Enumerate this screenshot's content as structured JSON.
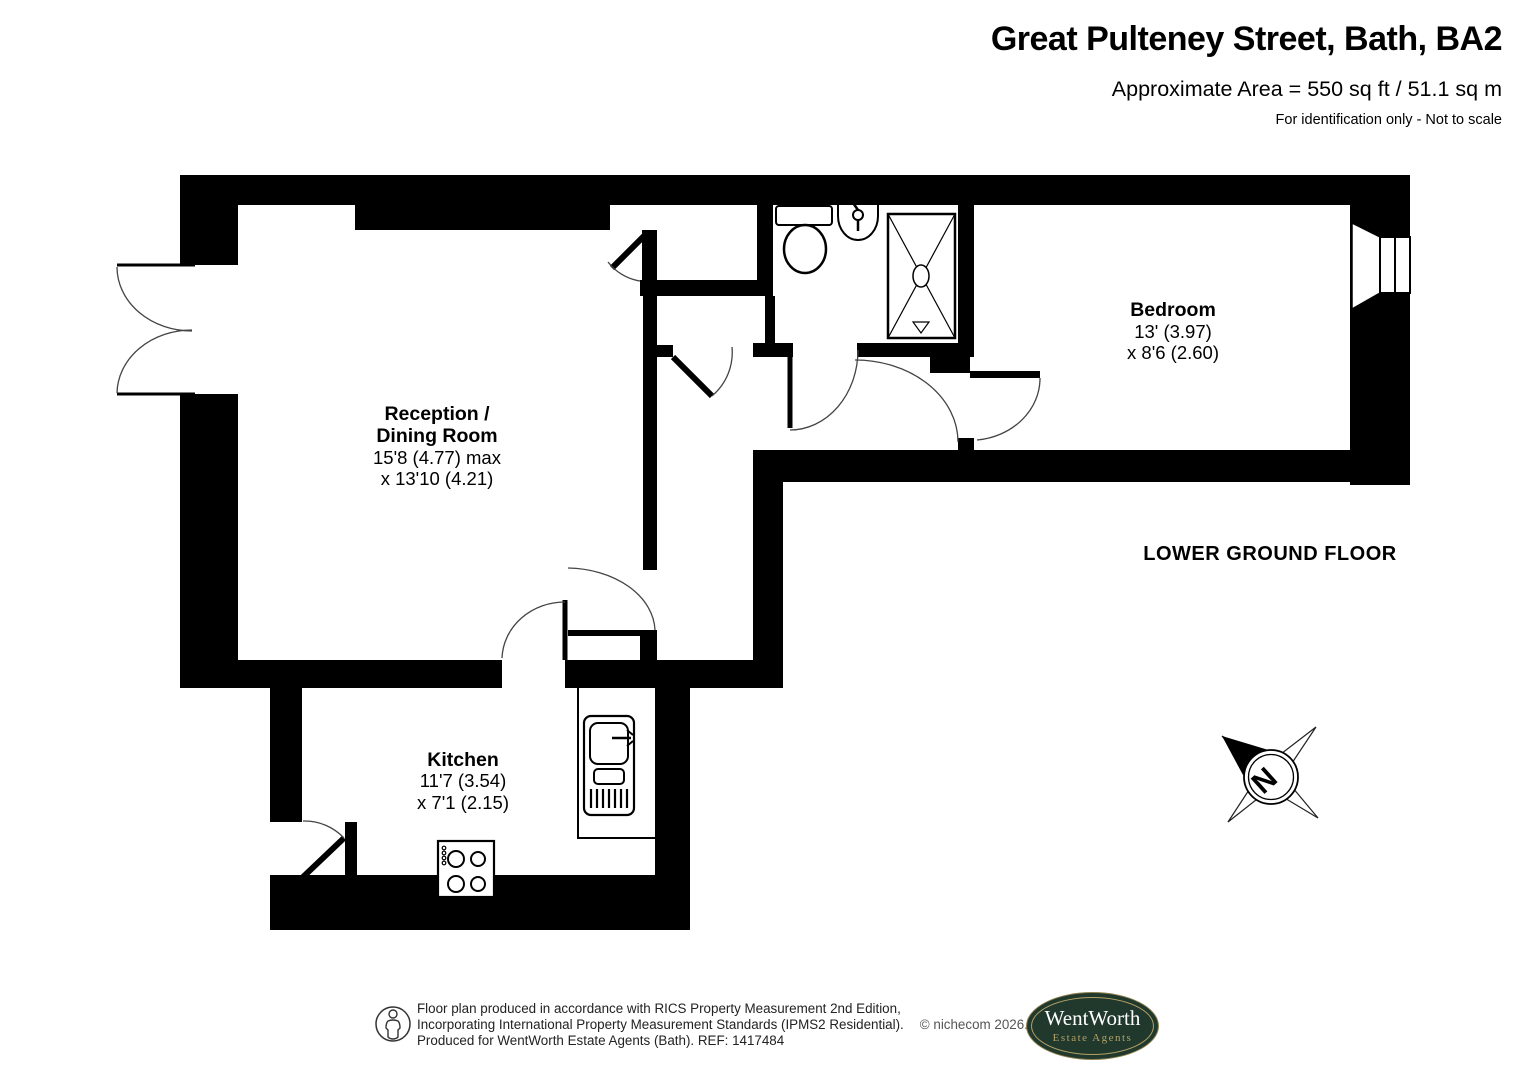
{
  "header": {
    "title": "Great Pulteney Street, Bath, BA2",
    "area_line": "Approximate Area = 550 sq ft / 51.1 sq m",
    "disclaimer": "For identification only - Not to scale"
  },
  "floor_label": "LOWER GROUND FLOOR",
  "compass": {
    "north_label": "N"
  },
  "rooms": {
    "reception": {
      "name": [
        "Reception /",
        "Dining Room"
      ],
      "dims": [
        "15'8 (4.77) max",
        "x 13'10 (4.21)"
      ]
    },
    "bedroom": {
      "name": [
        "Bedroom"
      ],
      "dims": [
        "13' (3.97)",
        "x 8'6 (2.60)"
      ]
    },
    "kitchen": {
      "name": [
        "Kitchen"
      ],
      "dims": [
        "11'7 (3.54)",
        "x 7'1 (2.15)"
      ]
    }
  },
  "icons": [
    "toilet-icon",
    "wash-basin-icon",
    "shower-icon",
    "kitchen-sink-icon",
    "hob-icon",
    "window-icon",
    "double-doors-icon",
    "compass-icon",
    "person-icon"
  ],
  "footer": {
    "lines": [
      "Floor plan produced in accordance with RICS Property Measurement 2nd Edition,",
      "Incorporating International Property Measurement Standards (IPMS2 Residential).",
      "Produced for WentWorth Estate Agents (Bath).   REF:  1417484"
    ],
    "copyright": "© nichecom 2026.",
    "logo": {
      "name": "WentWorth",
      "tagline": "Estate Agents"
    }
  },
  "colors": {
    "wall": "#000000",
    "door_arc": "#444444",
    "logo_green": "#20392c",
    "logo_gold": "#b3a068",
    "logo_border": "#8f7f4e"
  }
}
